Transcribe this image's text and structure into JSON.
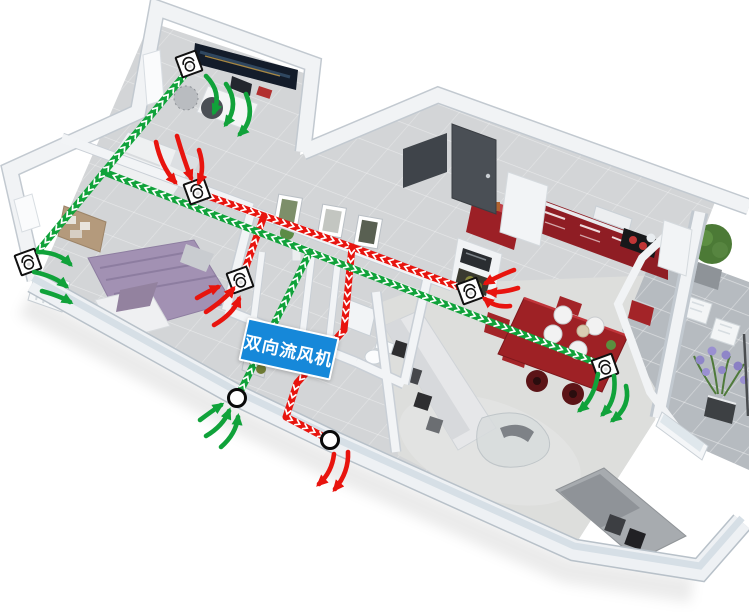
{
  "diagram": {
    "unit_label": {
      "text": "双向流风机"
    },
    "colors": {
      "supply": "#10a23a",
      "exhaust": "#e8140e",
      "chevron": "#ffffff",
      "label_bg": "#1688d9",
      "label_text": "#ffffff",
      "vent_box": "#ffffff",
      "vent_outline": "#111111"
    },
    "supply_lines": [
      [
        [
          237,
          398
        ],
        [
          310,
          252
        ]
      ],
      [
        [
          310,
          252
        ],
        [
          104,
          172
        ]
      ],
      [
        [
          104,
          172
        ],
        [
          191,
          67
        ]
      ],
      [
        [
          104,
          172
        ],
        [
          30,
          261
        ]
      ],
      [
        [
          310,
          252
        ],
        [
          602,
          365
        ]
      ]
    ],
    "exhaust_lines": [
      [
        [
          199,
          193
        ],
        [
          352,
          247
        ]
      ],
      [
        [
          467,
          290
        ],
        [
          352,
          247
        ]
      ],
      [
        [
          242,
          278
        ],
        [
          264,
          216
        ]
      ],
      [
        [
          352,
          247
        ],
        [
          344,
          330
        ],
        [
          297,
          383
        ],
        [
          286,
          417
        ],
        [
          328,
          439
        ]
      ]
    ],
    "vents": [
      {
        "x": 189,
        "y": 64,
        "room": "study-supply"
      },
      {
        "x": 197,
        "y": 191,
        "room": "bedroom2-exhaust"
      },
      {
        "x": 28,
        "y": 262,
        "room": "bedroom-west-supply"
      },
      {
        "x": 240,
        "y": 280,
        "room": "bedroom-east-exhaust"
      },
      {
        "x": 470,
        "y": 291,
        "room": "kitchen-exhaust"
      },
      {
        "x": 605,
        "y": 367,
        "room": "dining-supply"
      }
    ],
    "intake_node": {
      "x": 237,
      "y": 398
    },
    "exhaust_node": {
      "x": 330,
      "y": 440
    },
    "flow_arrows": [
      {
        "c": "supply",
        "d": [
          206,
          76,
          222,
          92,
          214,
          112
        ]
      },
      {
        "c": "supply",
        "d": [
          226,
          84,
          240,
          104,
          226,
          124
        ]
      },
      {
        "c": "supply",
        "d": [
          246,
          94,
          256,
          118,
          240,
          134
        ]
      },
      {
        "c": "supply",
        "d": [
          38,
          252,
          58,
          252,
          70,
          264
        ]
      },
      {
        "c": "supply",
        "d": [
          34,
          272,
          54,
          276,
          66,
          286
        ]
      },
      {
        "c": "supply",
        "d": [
          42,
          291,
          60,
          296,
          70,
          302
        ]
      },
      {
        "c": "supply",
        "d": [
          598,
          374,
          594,
          398,
          580,
          410
        ]
      },
      {
        "c": "supply",
        "d": [
          614,
          376,
          617,
          400,
          603,
          414
        ]
      },
      {
        "c": "supply",
        "d": [
          626,
          386,
          631,
          406,
          613,
          420
        ]
      },
      {
        "c": "supply",
        "d": [
          206,
          436,
          223,
          426,
          229,
          411
        ]
      },
      {
        "c": "supply",
        "d": [
          221,
          447,
          236,
          434,
          238,
          417
        ]
      },
      {
        "c": "supply",
        "d": [
          200,
          420,
          212,
          411,
          221,
          405
        ]
      },
      {
        "c": "exhaust",
        "d": [
          156,
          142,
          161,
          166,
          175,
          182
        ]
      },
      {
        "c": "exhaust",
        "d": [
          177,
          136,
          184,
          160,
          191,
          178
        ]
      },
      {
        "c": "exhaust",
        "d": [
          199,
          150,
          205,
          168,
          199,
          182
        ]
      },
      {
        "c": "exhaust",
        "d": [
          206,
          312,
          224,
          300,
          233,
          289
        ]
      },
      {
        "c": "exhaust",
        "d": [
          214,
          325,
          233,
          314,
          239,
          299
        ]
      },
      {
        "c": "exhaust",
        "d": [
          197,
          298,
          209,
          291,
          218,
          287
        ]
      },
      {
        "c": "exhaust",
        "d": [
          514,
          270,
          498,
          276,
          486,
          283
        ]
      },
      {
        "c": "exhaust",
        "d": [
          518,
          288,
          502,
          293,
          489,
          292
        ]
      },
      {
        "c": "exhaust",
        "d": [
          510,
          306,
          496,
          308,
          485,
          299
        ]
      },
      {
        "c": "exhaust",
        "d": [
          334,
          454,
          332,
          472,
          319,
          484
        ]
      },
      {
        "c": "exhaust",
        "d": [
          348,
          452,
          349,
          472,
          335,
          489
        ]
      }
    ]
  }
}
